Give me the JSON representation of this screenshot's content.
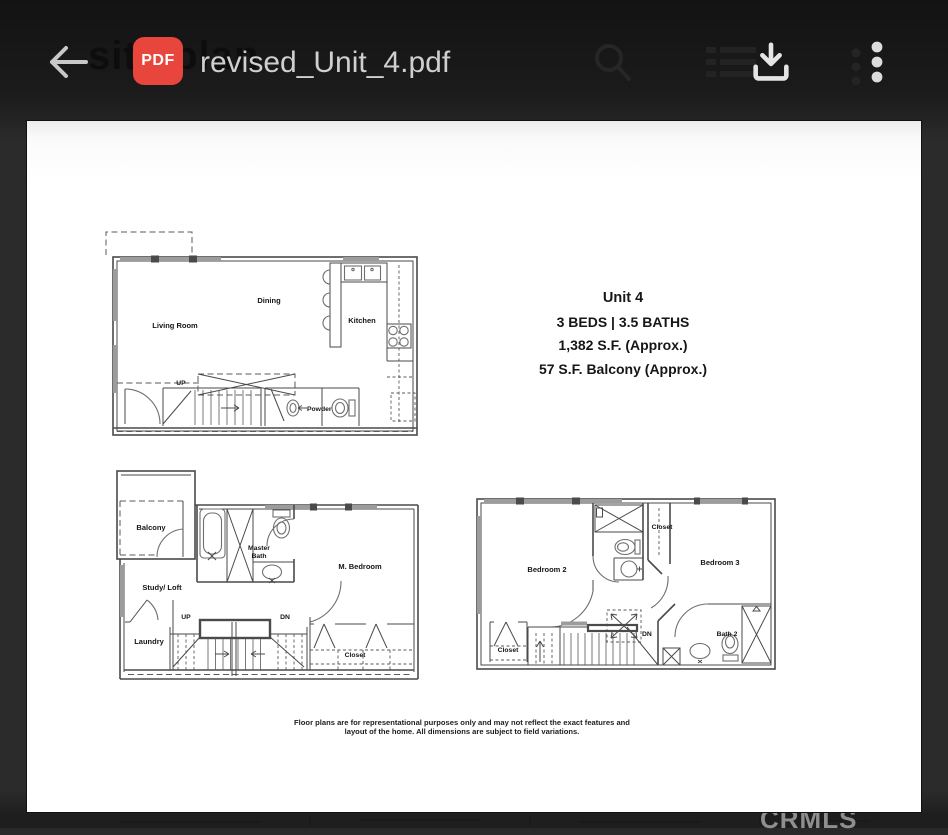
{
  "header": {
    "ghost_title": "site plan",
    "pdf_badge": "PDF",
    "title": "revised_Unit_4.pdf",
    "icons": {
      "back": "arrow-left",
      "search_ghost": "magnifier",
      "list_ghost": "queue-rows",
      "download": "arrow-into-tray",
      "menu": "vertical-kebab-dots"
    }
  },
  "doc": {
    "unit": {
      "name": "Unit 4",
      "beds_baths": "3 BEDS | 3.5 BATHS",
      "sqft": "1,382 S.F. (Approx.)",
      "balcony": "57 S.F. Balcony (Approx.)"
    },
    "disclaimer1": "Floor plans are for representational purposes only and may not reflect the exact features and",
    "disclaimer2": "layout of the home. All dimensions are subject to field variations.",
    "l1": {
      "living": "Living Room",
      "dining": "Dining",
      "kitchen": "Kitchen",
      "up": "UP",
      "powder": "Powder"
    },
    "l2": {
      "balcony": "Balcony",
      "master1": "Master",
      "master2": "Bath",
      "mbed": "M. Bedroom",
      "study": "Study/ Loft",
      "laundry": "Laundry",
      "up": "UP",
      "dn": "DN",
      "closet": "Closet"
    },
    "l3": {
      "bed2": "Bedroom 2",
      "closet_top": "Closet",
      "bed3": "Bedroom 3",
      "dn": "DN",
      "bath2": "Bath 2",
      "closet_bottom": "Closet"
    }
  },
  "watermark": "CRMLS",
  "colors": {
    "accent_red": "#e8453c",
    "appbar": "#171717",
    "page": "#ffffff"
  }
}
